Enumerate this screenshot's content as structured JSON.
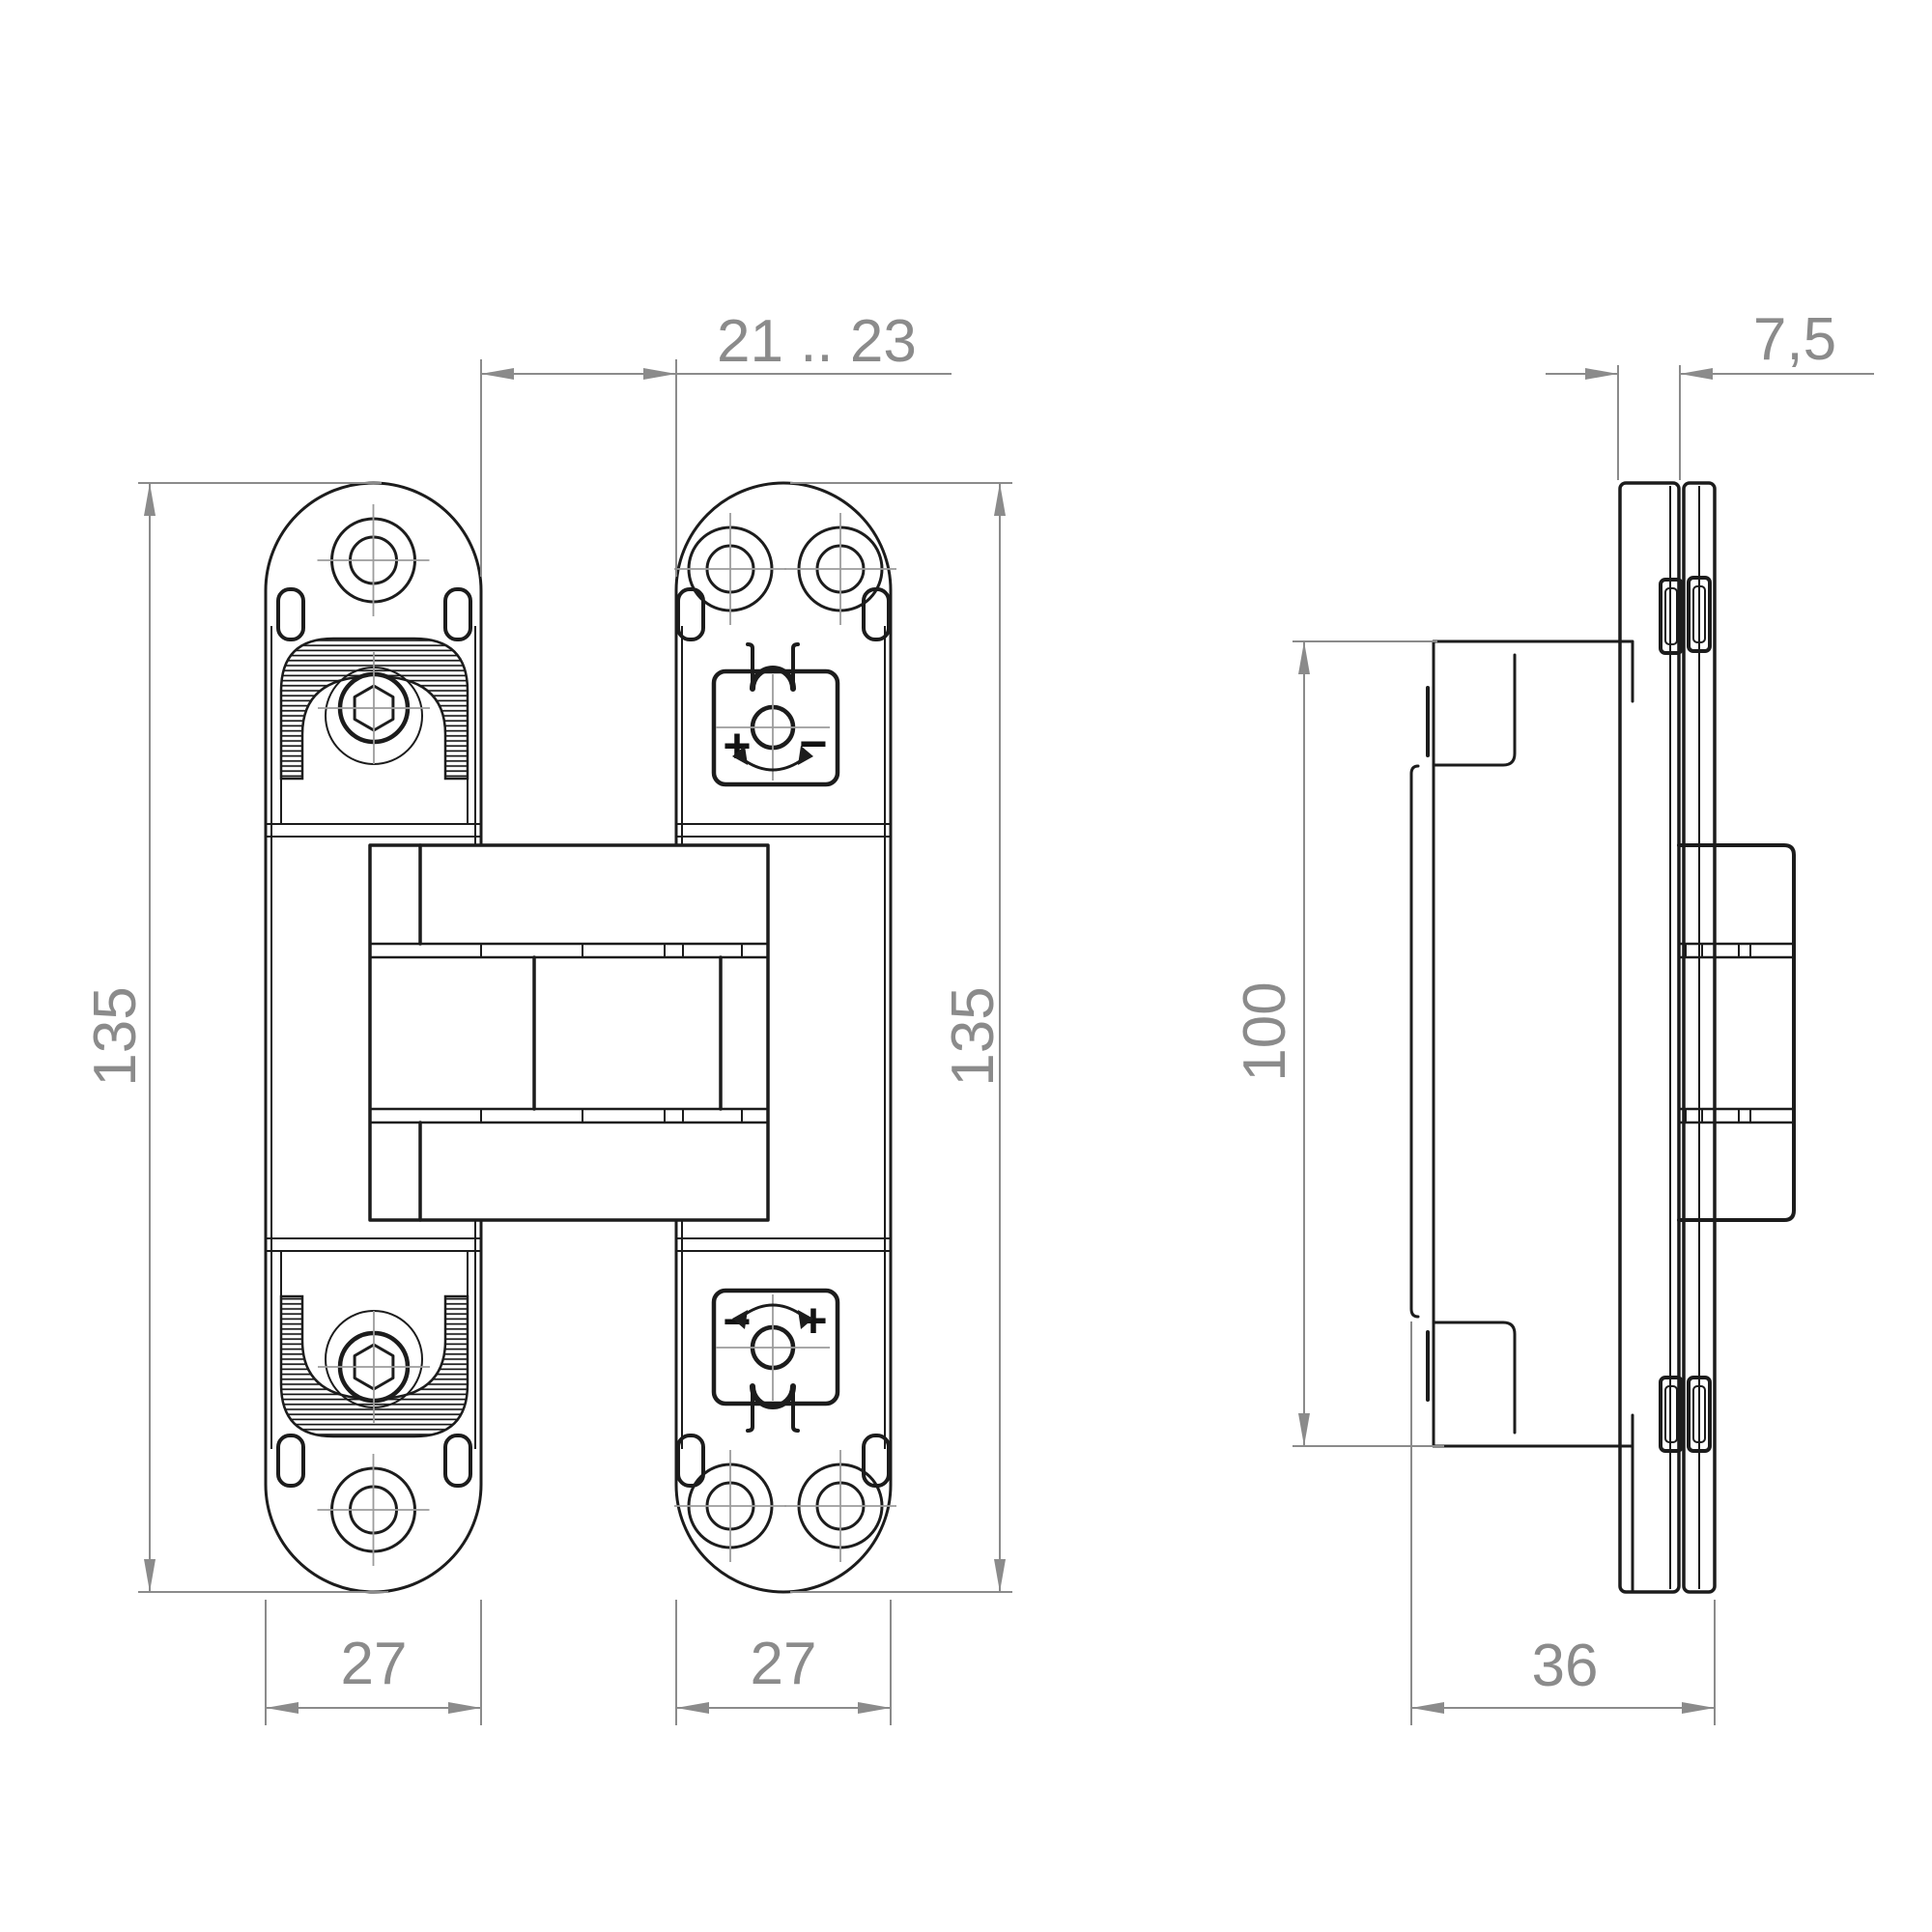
{
  "meta": {
    "title": "Concealed hinge technical drawing",
    "background": "#ffffff"
  },
  "colors": {
    "line": "#1c1c1c",
    "dimension": "#8b8b8b",
    "centerline": "#9c9c9c"
  },
  "dims": {
    "gap": "21 .. 23",
    "height_left": "135",
    "height_right": "135",
    "width_left": "27",
    "width_right": "27",
    "thickness": "7,5",
    "door_height": "100",
    "depth": "36"
  },
  "symbols": {
    "top_left": "+",
    "top_right": "−",
    "bottom_left": "−",
    "bottom_right": "+"
  },
  "icons": [
    "screw-hole-icon",
    "hex-bolt-icon",
    "mounting-slot-icon",
    "rotation-arrow-icon",
    "plus-symbol",
    "minus-symbol"
  ]
}
